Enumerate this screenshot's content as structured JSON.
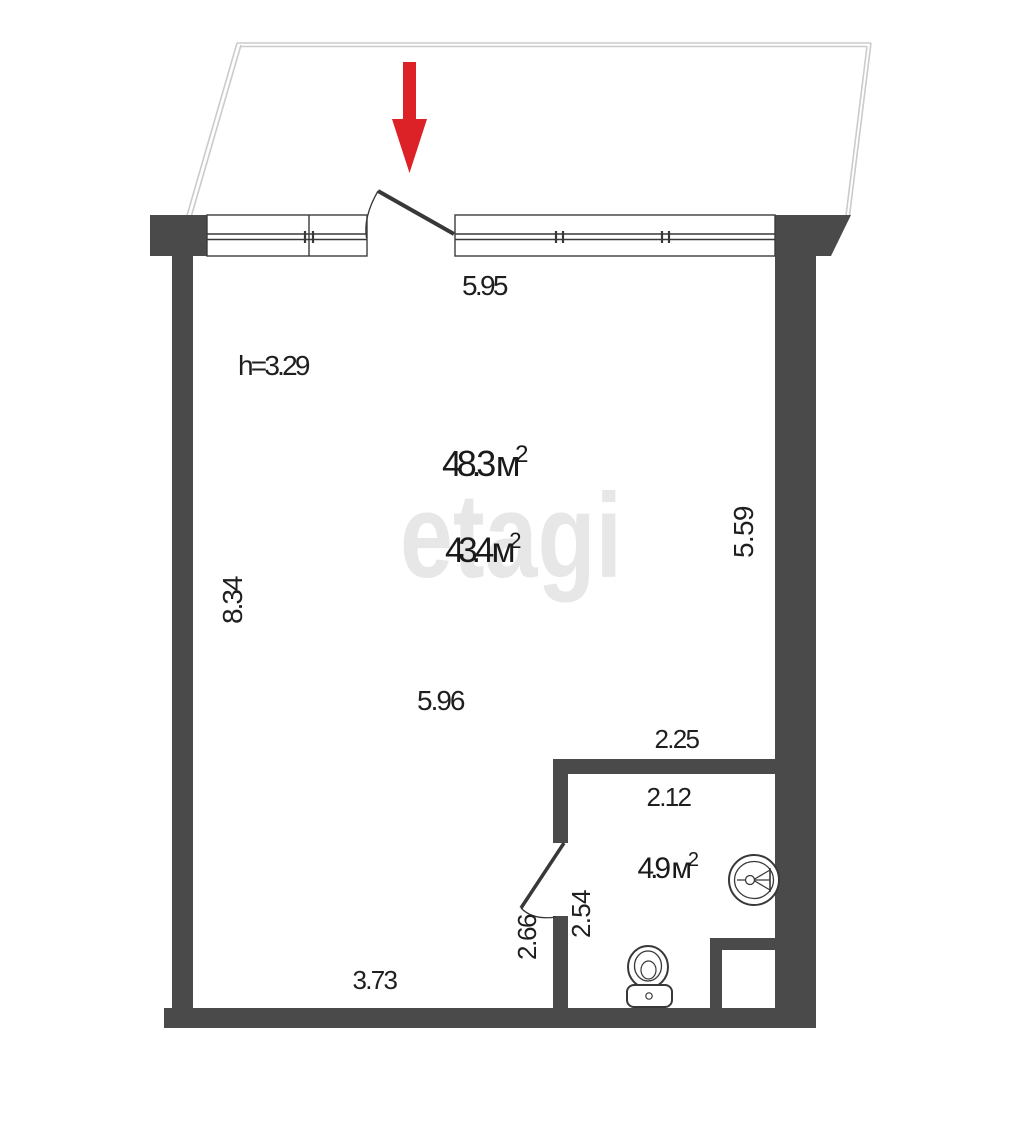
{
  "watermark": "etagi",
  "colors": {
    "wall": "#4a4a4a",
    "entrance_arrow": "#dc2127",
    "plan_lines": "#383838",
    "balcony_outline": "#cbcbcb",
    "text": "#1f1f1f",
    "watermark": "#e7e7e7"
  },
  "labels": {
    "entry_opening_width": "5.95",
    "ceiling_height": "h=3.29",
    "total_area_value": "48.3 м",
    "total_area_sup": "2",
    "room_area_value": "43.4 м",
    "room_area_sup": "2",
    "left_wall_length": "8.34",
    "right_wall_length": "5.59",
    "room_width": "5.96",
    "bathroom_outer_width": "2.25",
    "bathroom_inner_width": "2.12",
    "bathroom_area_value": "4.9 м",
    "bathroom_area_sup": "2",
    "bathroom_inner_depth": "2.54",
    "bathroom_door_wall": "2.66",
    "bottom_wall_length": "3.73"
  }
}
